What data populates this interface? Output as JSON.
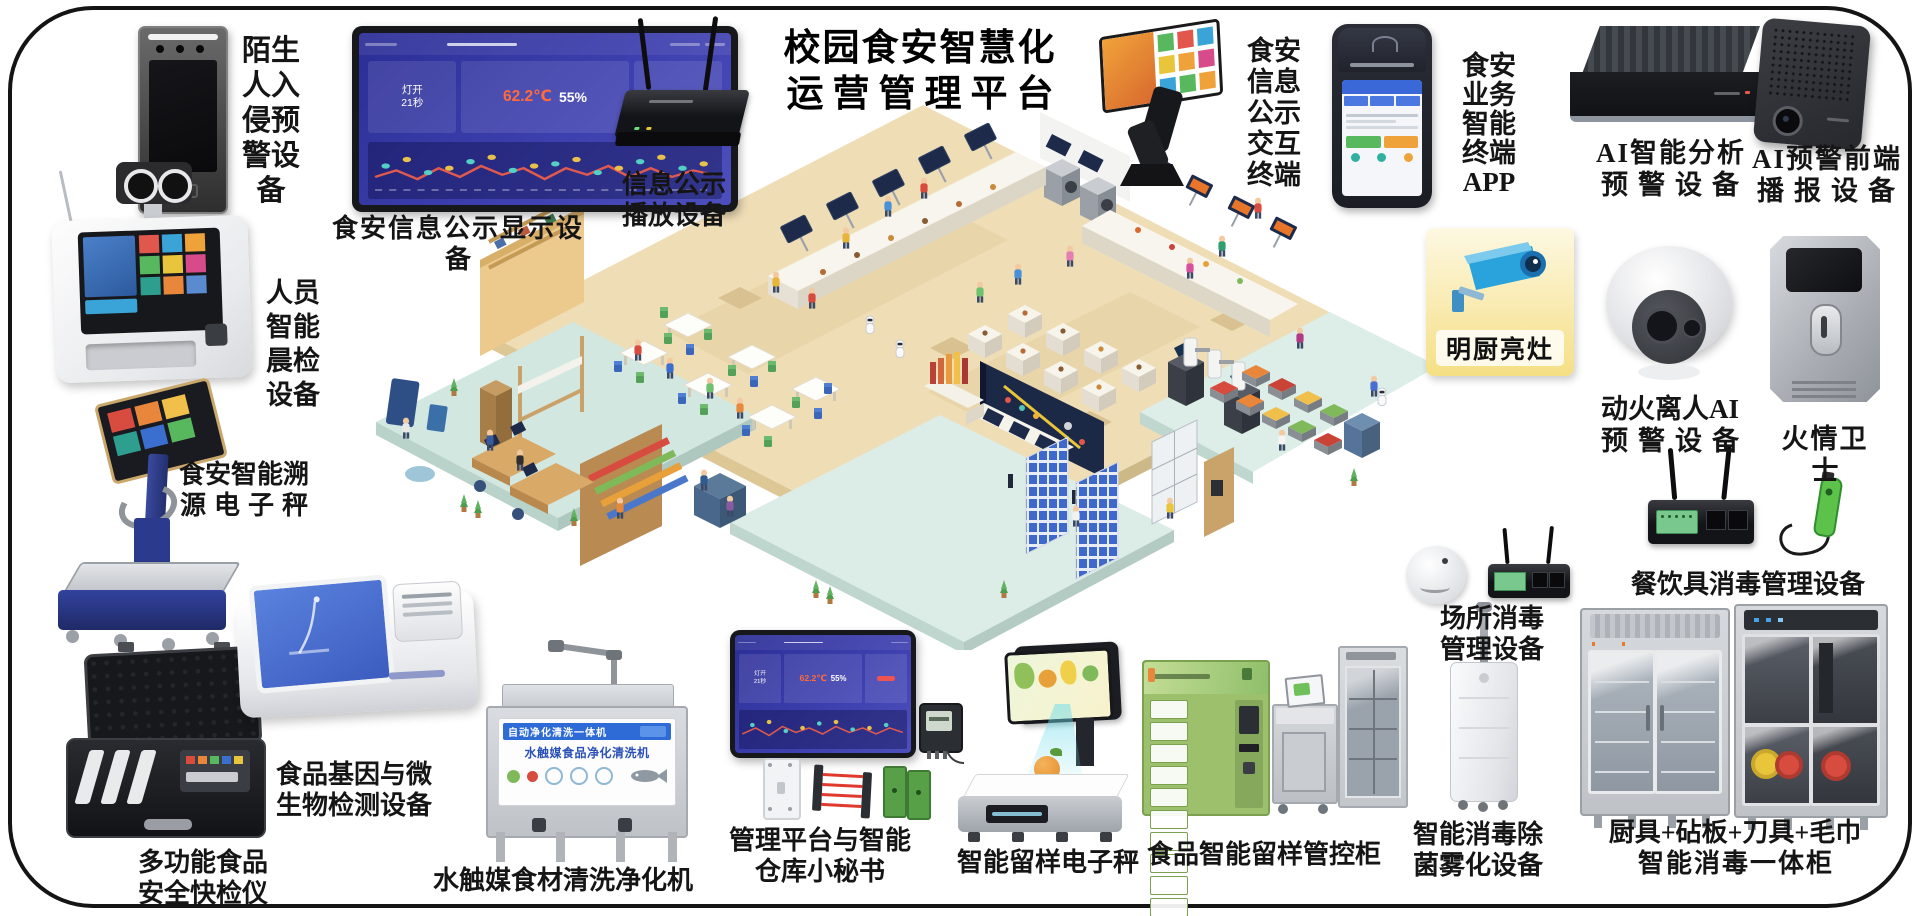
{
  "title": {
    "line1": "校园食安智慧化",
    "line2": "运营管理平台"
  },
  "labels": {
    "stranger": "陌生人入侵预警设备",
    "display_screen": "食安信息公示显示设备",
    "player_l1": "信息公示",
    "player_l2": "播放设备",
    "kiosk": "食安信息公示交互终端",
    "app": "食安业务智能终端APP",
    "ai_analysis_l1": "AI智能分析",
    "ai_analysis_l2": "预警设备",
    "ai_broadcast_l1": "AI预警前端",
    "ai_broadcast_l2": "播报设备",
    "mingchu": "明厨亮灶",
    "fire_ai_l1": "动火离人AI",
    "fire_ai_l2": "预警设备",
    "fire_guard": "火情卫士",
    "tableware": "餐饮具消毒管理设备",
    "venue_l1": "场所消毒",
    "venue_l2": "管理设备",
    "atomizer_l1": "智能消毒除",
    "atomizer_l2": "菌雾化设备",
    "combo_l1": "厨具+砧板+刀具+毛巾",
    "combo_l2": "智能消毒一体柜",
    "sample_cabinet": "食品智能留样管控柜",
    "sample_scale": "智能留样电子秤",
    "mgmt_l1": "管理平台与智能",
    "mgmt_l2": "仓库小秘书",
    "washer": "水触媒食材清洗净化机",
    "gene_l1": "食品基因与微",
    "gene_l2": "生物检测设备",
    "quick_l1": "多功能食品",
    "quick_l2": "安全快检仪",
    "person_check": "人员智能晨检设备",
    "trace_l1": "食安智能溯",
    "trace_l2": "源电子秤"
  },
  "dashboard": {
    "card1_line1": "灯开",
    "card1_line2": "21秒",
    "temperature": "62.2℃",
    "humidity": "55%"
  },
  "washer_panel": {
    "strip": "自动净化清洗一体机",
    "name": "水触媒食品净化清洗机"
  },
  "colors": {
    "frame": "#141414",
    "dashboard_bg": "#3d3fae",
    "temperature": "#ff6a3c",
    "mingchu_card": "#f7e18e",
    "camera_blue": "#2aa3dc",
    "locker_green": "#9cc06c"
  }
}
